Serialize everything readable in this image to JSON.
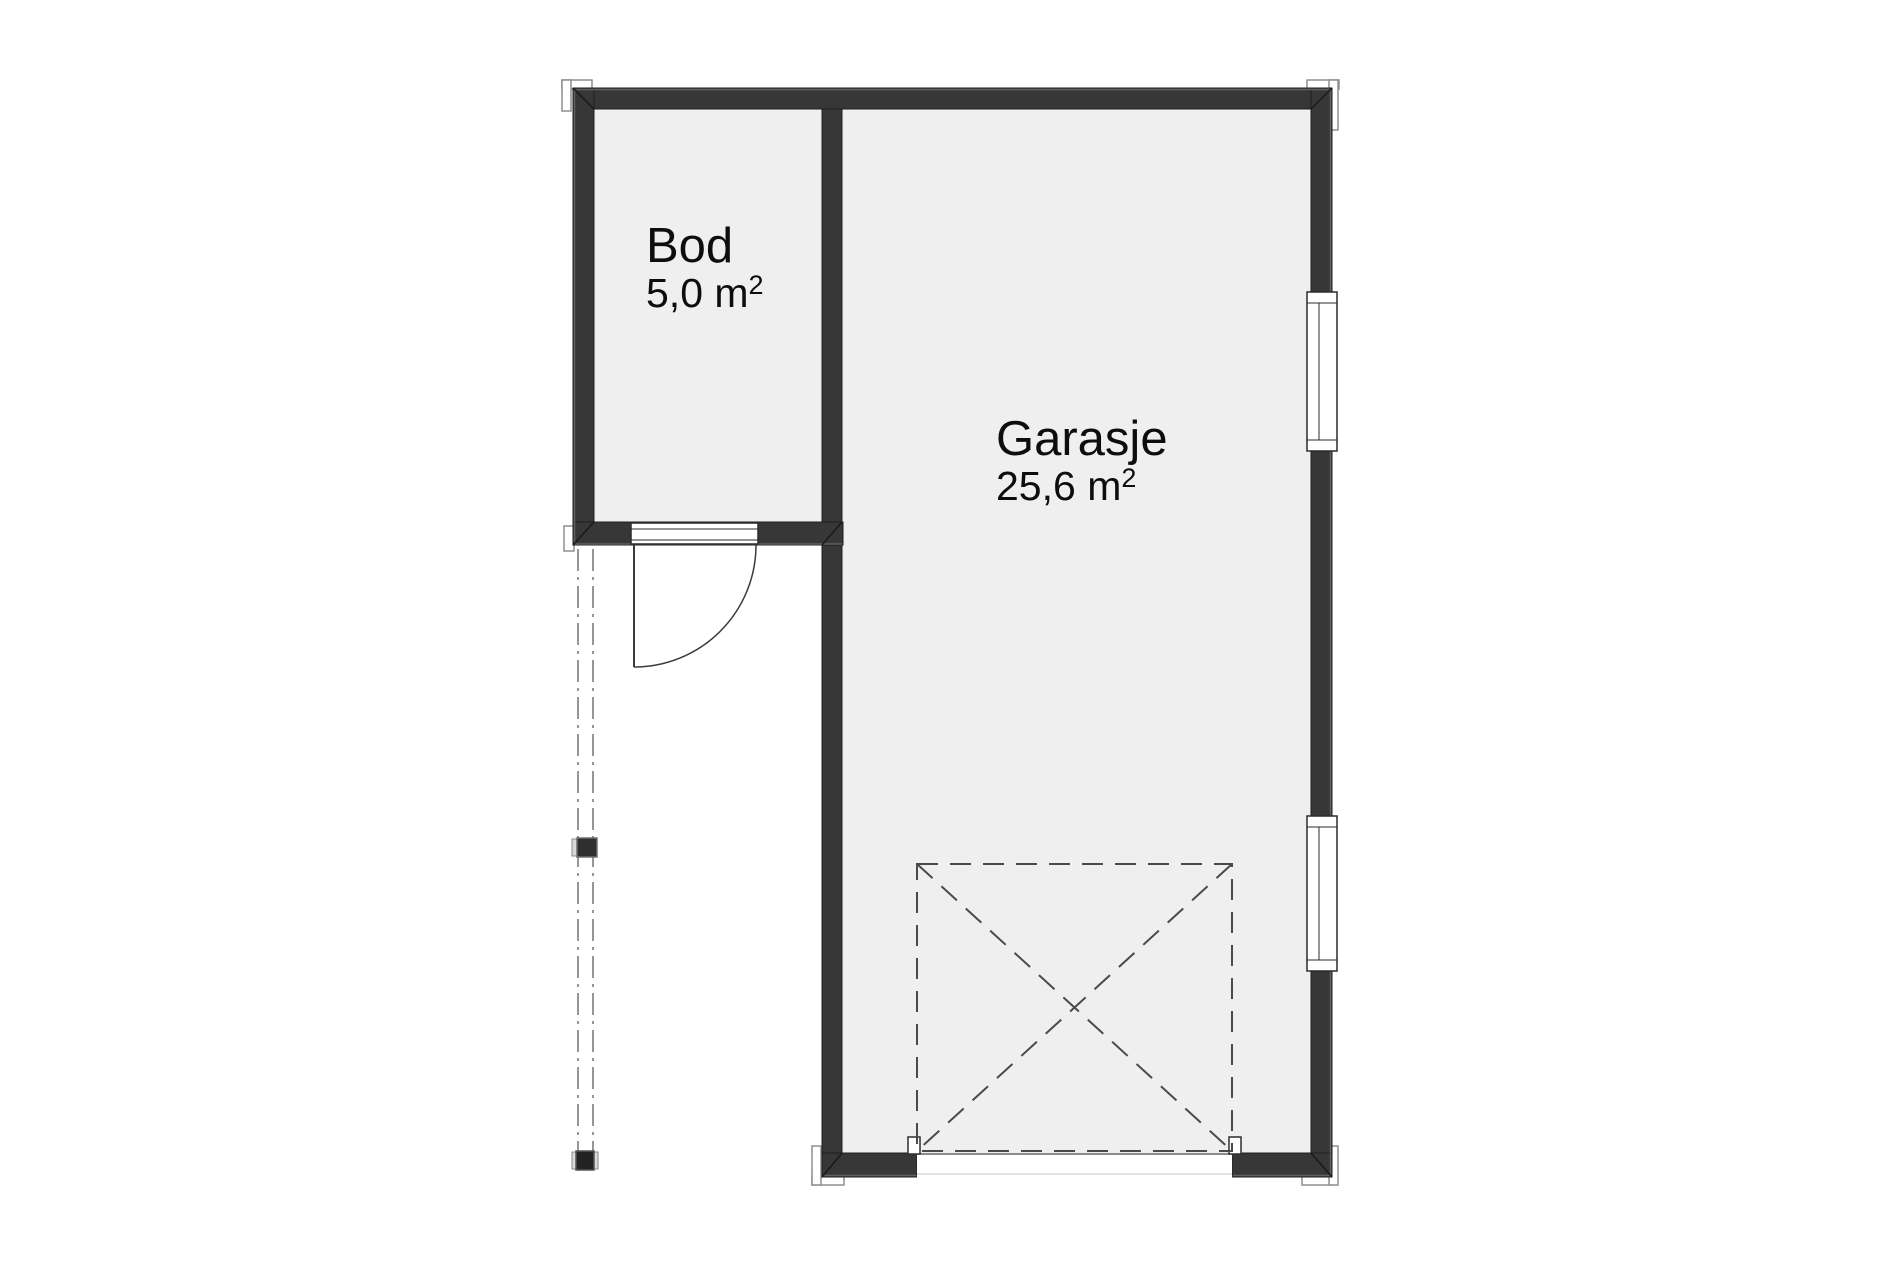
{
  "plan": {
    "title": "Garage floor plan",
    "rooms": [
      {
        "id": "bod",
        "name": "Bod",
        "area_label": "5,0 m²",
        "area_value": "5,0 m",
        "area_sup": "2"
      },
      {
        "id": "garasje",
        "name": "Garasje",
        "area_label": "25,6 m²",
        "area_value": "25,6 m",
        "area_sup": "2"
      }
    ],
    "colors": {
      "background": "#ffffff",
      "floor": "#efefef",
      "wall": "#373737",
      "wall_outline": "#1f1f1f",
      "wall_highlight": "#616161",
      "opening_frame": "#2b2b2b",
      "dashed_box": "#4a4a4a",
      "dashdot_line": "#969696",
      "trim_outline": "#8f8f8f",
      "text": "#0d0d0d"
    }
  }
}
